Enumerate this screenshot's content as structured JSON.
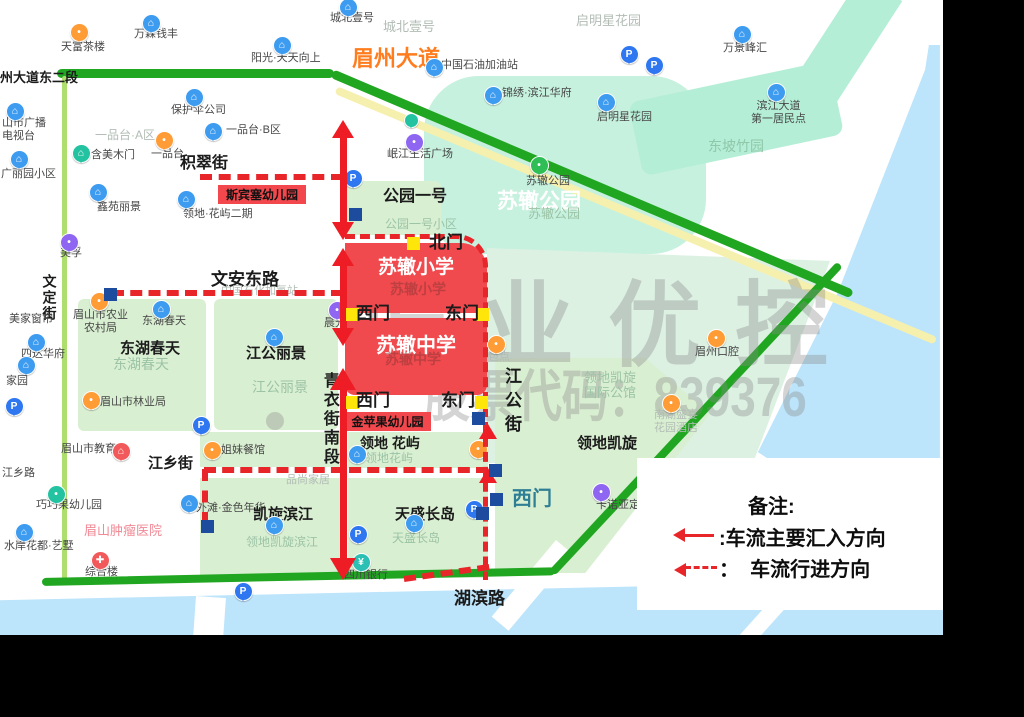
{
  "canvas": {
    "width": 1024,
    "height": 717,
    "map_width": 943,
    "map_height": 635,
    "frame_color": "#000000",
    "map_bg": "#ffffff"
  },
  "palette": {
    "road_green": "#21a621",
    "road_yellow": "#f6f0ae",
    "road_lightgreen": "#aede6e",
    "block_green": "#d9efd2",
    "mint": "#c6f1de",
    "mint2": "#b4eed6",
    "mint3": "#ddf1e3",
    "water": "#bce4fb",
    "white": "#ffffff",
    "red": "#ee1c25",
    "dash_red": "#e8262a",
    "school_red": "#f04a4e",
    "box_red": "#f2484d",
    "yellow_sq": "#ffe60a",
    "blue_sq": "#1d4c9f",
    "pin_blue": "#3d9bf0",
    "pin_orange": "#ff9c35",
    "pin_purple": "#8f66f2",
    "pin_magenta": "#ea5cb5",
    "pin_teal": "#23c2a0",
    "pin_green": "#2ebe55",
    "pin_red": "#f2595b",
    "pin_pblue": "#2e77f0",
    "pin_bank": "#2cc0b4"
  },
  "text_colors": {
    "A": "#474747",
    "B": "#1b1b1b",
    "G": "#9cc3a6",
    "G2": "#8fc7a9",
    "Y": "#b2bcb5",
    "W": "#ffffff",
    "P": "#f08a96",
    "O": "#ff7d1e",
    "R": "rgba(150,55,55,0.55)",
    "T": "#2e7f95"
  },
  "watermark": {
    "line1": "振业优控",
    "line2": "股票代码：839376"
  },
  "legend": {
    "title": "备注:",
    "items": [
      {
        "icon": "solid-left-arrow",
        "label": ":车流主要汇入方向"
      },
      {
        "icon": "dashed-left-arrow",
        "label": "：  车流行进方向"
      }
    ]
  },
  "areas": [
    {
      "name": "suzhe-park",
      "x": 424,
      "y": 76,
      "w": 282,
      "h": 178,
      "color": "mint",
      "radius": "55px"
    },
    {
      "name": "dongpo-bamboo-area",
      "x": 628,
      "y": 103,
      "w": 205,
      "h": 75,
      "color": "mint2",
      "rot": -12,
      "radius": "10px"
    },
    {
      "name": "top-right-band",
      "x": 862,
      "y": -25,
      "w": 48,
      "h": 135,
      "color": "mint2",
      "rot": 33
    },
    {
      "name": "gongyuan-yihao-block",
      "x": 341,
      "y": 181,
      "w": 100,
      "h": 54,
      "color": "block_green",
      "radius": "6px"
    },
    {
      "name": "donghu-block",
      "x": 78,
      "y": 299,
      "w": 128,
      "h": 132,
      "color": "block_green",
      "radius": "6px"
    },
    {
      "name": "jianggong-lijing-block",
      "x": 214,
      "y": 299,
      "w": 124,
      "h": 131,
      "color": "block_green",
      "radius": "6px"
    },
    {
      "name": "jiemei-strip",
      "x": 200,
      "y": 432,
      "w": 141,
      "h": 35,
      "color": "block_green"
    },
    {
      "name": "kaixuan-binjiang-block",
      "x": 200,
      "y": 478,
      "w": 141,
      "h": 100,
      "color": "block_green"
    },
    {
      "name": "lingdi-huayu-block",
      "x": 348,
      "y": 432,
      "w": 140,
      "h": 36,
      "color": "block_green"
    },
    {
      "name": "tiansheng-block",
      "x": 348,
      "y": 478,
      "w": 140,
      "h": 100,
      "color": "block_green"
    },
    {
      "name": "east-mint-region",
      "x": 487,
      "y": 248,
      "w": 350,
      "h": 215,
      "color": "mint3",
      "clip": "polygon(0 0,98% 6%,76% 100%,0 100%)"
    },
    {
      "name": "lingdi-kaixuan-block",
      "x": 495,
      "y": 358,
      "w": 215,
      "h": 215,
      "color": "block_green",
      "clip": "polygon(0 0,70% 0,100% 26%,42% 100%,0 100%)"
    }
  ],
  "water": [
    {
      "name": "river-east",
      "x": 750,
      "y": 40,
      "w": 193,
      "h": 505,
      "color": "water",
      "clip": "polygon(92.7% 1%,98.4% 1%,98.4% 100%,77.7% 100%,4.1% 81.6%,45.6% 49.9%,90.7% 5.9%)"
    },
    {
      "name": "river-south",
      "x": 0,
      "y": 575,
      "w": 943,
      "h": 60,
      "color": "water",
      "clip": "polygon(0 42%,100% 8%,100% 100%,0 100%)"
    },
    {
      "name": "bridge-gap-1",
      "x": 196,
      "y": 596,
      "w": 30,
      "h": 42,
      "color": "white",
      "rot": 4
    },
    {
      "name": "bridge-gap-2",
      "x": 556,
      "y": 540,
      "w": 22,
      "h": 100,
      "color": "white",
      "rot": 40
    },
    {
      "name": "bridge-gap-3",
      "x": 800,
      "y": 568,
      "w": 16,
      "h": 90,
      "color": "white",
      "rot": 42
    }
  ],
  "roads": [
    {
      "name": "riverside-yellow-road",
      "x": 336,
      "y": 86,
      "w": 650,
      "h": 8,
      "color": "road_yellow",
      "rot": 22.7
    },
    {
      "name": "meizhou-dadao-west",
      "x": 57,
      "y": 69,
      "w": 277,
      "h": 9,
      "color": "road_green"
    },
    {
      "name": "meizhou-dadao-east",
      "x": 332,
      "y": 69,
      "w": 565,
      "h": 9,
      "color": "road_green",
      "rot": 23
    },
    {
      "name": "wending-street-road",
      "x": 62,
      "y": 76,
      "w": 5,
      "h": 507,
      "color": "road_lightgreen"
    },
    {
      "name": "hubin-road-west",
      "x": 42,
      "y": 578,
      "w": 513,
      "h": 8,
      "color": "road_green",
      "rot": -1.2
    },
    {
      "name": "hubin-road-east",
      "x": 552,
      "y": 569,
      "w": 422,
      "h": 8,
      "color": "road_green",
      "rot": -47
    }
  ],
  "labels": [
    {
      "t": "州大道东二段",
      "x": 0,
      "y": 70,
      "s": 13,
      "c": "B",
      "b": 1
    },
    {
      "t": "眉州大道",
      "x": 352,
      "y": 46,
      "s": 22,
      "c": "O",
      "b": 1
    },
    {
      "t": "天富茶楼",
      "x": 61,
      "y": 41,
      "s": 11,
      "c": "A"
    },
    {
      "t": "万霖钱丰",
      "x": 134,
      "y": 28,
      "s": 11,
      "c": "A"
    },
    {
      "t": "阳光·天天向上",
      "x": 251,
      "y": 52,
      "s": 11,
      "c": "A"
    },
    {
      "t": "城北壹号",
      "x": 330,
      "y": 12,
      "s": 11,
      "c": "A"
    },
    {
      "t": "城北壹号",
      "x": 383,
      "y": 19,
      "s": 13,
      "c": "Y"
    },
    {
      "t": "启明星花园",
      "x": 576,
      "y": 13,
      "s": 13,
      "c": "Y"
    },
    {
      "t": "万景峰汇",
      "x": 723,
      "y": 42,
      "s": 11,
      "c": "A"
    },
    {
      "t": "中国石油加油站",
      "x": 441,
      "y": 59,
      "s": 11,
      "c": "A"
    },
    {
      "t": "锦绣·滨江华府",
      "x": 502,
      "y": 87,
      "s": 11,
      "c": "A"
    },
    {
      "t": "启明星花园",
      "x": 597,
      "y": 111,
      "s": 11,
      "c": "A"
    },
    {
      "t": "滨江大道\n第一居民点",
      "x": 751,
      "y": 100,
      "s": 11,
      "c": "A",
      "ctr": 1
    },
    {
      "t": "东坡竹园",
      "x": 708,
      "y": 138,
      "s": 14,
      "c": "G2"
    },
    {
      "t": "保护伞公司",
      "x": 171,
      "y": 104,
      "s": 11,
      "c": "A"
    },
    {
      "t": "一品台·A区",
      "x": 95,
      "y": 128,
      "s": 12,
      "c": "Y"
    },
    {
      "t": "一品台·B区",
      "x": 226,
      "y": 124,
      "s": 11,
      "c": "A"
    },
    {
      "t": "一品台",
      "x": 151,
      "y": 148,
      "s": 11,
      "c": "A"
    },
    {
      "t": "含美木门",
      "x": 91,
      "y": 149,
      "s": 11,
      "c": "A"
    },
    {
      "t": "山市广播\n电视台",
      "x": 2,
      "y": 117,
      "s": 11,
      "c": "A"
    },
    {
      "t": "广丽园小区",
      "x": 1,
      "y": 168,
      "s": 11,
      "c": "A"
    },
    {
      "t": "鑫苑丽景",
      "x": 97,
      "y": 201,
      "s": 11,
      "c": "A"
    },
    {
      "t": "领地·花屿二期",
      "x": 183,
      "y": 208,
      "s": 11,
      "c": "A"
    },
    {
      "t": "积翠街",
      "x": 180,
      "y": 155,
      "s": 16,
      "c": "B",
      "b": 1
    },
    {
      "t": "公园一号",
      "x": 383,
      "y": 188,
      "s": 16,
      "c": "B",
      "b": 1
    },
    {
      "t": "公园一号小区",
      "x": 385,
      "y": 217,
      "s": 12,
      "c": "G"
    },
    {
      "t": "苏辙公园",
      "x": 497,
      "y": 190,
      "s": 21,
      "c": "W",
      "b": 1
    },
    {
      "t": "苏辙公园",
      "x": 526,
      "y": 175,
      "s": 11,
      "c": "A"
    },
    {
      "t": "苏辙公园",
      "x": 528,
      "y": 206,
      "s": 13,
      "c": "G"
    },
    {
      "t": "岷江生活广场",
      "x": 387,
      "y": 148,
      "s": 11,
      "c": "A"
    },
    {
      "t": "美孚",
      "x": 60,
      "y": 247,
      "s": 11,
      "c": "A"
    },
    {
      "t": "文安东路",
      "x": 211,
      "y": 270,
      "s": 17,
      "c": "B",
      "b": 1
    },
    {
      "t": "中国石化加氢站",
      "x": 221,
      "y": 285,
      "s": 11,
      "c": "Y"
    },
    {
      "t": "晨光文具",
      "x": 324,
      "y": 317,
      "s": 11,
      "c": "A"
    },
    {
      "t": "文定街",
      "x": 41,
      "y": 274,
      "s": 14,
      "c": "B",
      "b": 1,
      "v": 1,
      "ls": 2
    },
    {
      "t": "美家窗帘",
      "x": 9,
      "y": 313,
      "s": 11,
      "c": "A"
    },
    {
      "t": "四达华府",
      "x": 21,
      "y": 348,
      "s": 11,
      "c": "A"
    },
    {
      "t": "家园",
      "x": 6,
      "y": 375,
      "s": 11,
      "c": "A"
    },
    {
      "t": "眉山市农业\n农村局",
      "x": 73,
      "y": 309,
      "s": 11,
      "c": "A",
      "ctr": 1
    },
    {
      "t": "东湖春天",
      "x": 142,
      "y": 315,
      "s": 11,
      "c": "A"
    },
    {
      "t": "东湖春天",
      "x": 120,
      "y": 340,
      "s": 15,
      "c": "B",
      "b": 1
    },
    {
      "t": "东湖春天",
      "x": 113,
      "y": 356,
      "s": 14,
      "c": "G"
    },
    {
      "t": "江公丽景",
      "x": 246,
      "y": 345,
      "s": 15,
      "c": "B",
      "b": 1
    },
    {
      "t": "江公丽景",
      "x": 252,
      "y": 379,
      "s": 14,
      "c": "G"
    },
    {
      "t": "眉山市林业局",
      "x": 100,
      "y": 396,
      "s": 11,
      "c": "A"
    },
    {
      "t": "青衣街南段",
      "x": 319,
      "y": 372,
      "s": 16,
      "c": "B",
      "b": 1,
      "v": 1,
      "ls": 3
    },
    {
      "t": "江公街",
      "x": 501,
      "y": 367,
      "s": 17,
      "c": "B",
      "b": 1,
      "v": 1,
      "ls": 7
    },
    {
      "t": "香兰麻辣烫",
      "x": 348,
      "y": 380,
      "s": 11,
      "c": "Y"
    },
    {
      "t": "紫燕包点",
      "x": 466,
      "y": 351,
      "s": 11,
      "c": "Y"
    },
    {
      "t": "领地凯旋\n国际公馆",
      "x": 584,
      "y": 370,
      "s": 13,
      "c": "G"
    },
    {
      "t": "眉州口腔",
      "x": 695,
      "y": 346,
      "s": 11,
      "c": "A"
    },
    {
      "t": "南湖盛宴\n花园酒店",
      "x": 654,
      "y": 409,
      "s": 11,
      "c": "Y",
      "ctr": 1
    },
    {
      "t": "领地凯旋",
      "x": 577,
      "y": 435,
      "s": 15,
      "c": "B",
      "b": 1
    },
    {
      "t": "江乡路",
      "x": 2,
      "y": 467,
      "s": 11,
      "c": "A"
    },
    {
      "t": "眉山市教育局",
      "x": 61,
      "y": 443,
      "s": 11,
      "c": "A"
    },
    {
      "t": "江乡街",
      "x": 148,
      "y": 455,
      "s": 15,
      "c": "B",
      "b": 1
    },
    {
      "t": "姐妹餐馆",
      "x": 221,
      "y": 444,
      "s": 11,
      "c": "A"
    },
    {
      "t": "领地 花屿",
      "x": 360,
      "y": 435,
      "s": 14,
      "c": "B",
      "b": 1
    },
    {
      "t": "领地花屿",
      "x": 365,
      "y": 451,
      "s": 12,
      "c": "G"
    },
    {
      "t": "品尚家居",
      "x": 286,
      "y": 474,
      "s": 11,
      "c": "Y"
    },
    {
      "t": "巧巧果幼儿园",
      "x": 36,
      "y": 499,
      "s": 11,
      "c": "A"
    },
    {
      "t": "外滩·金色年华",
      "x": 196,
      "y": 502,
      "s": 11,
      "c": "A"
    },
    {
      "t": "凯旋滨江",
      "x": 253,
      "y": 506,
      "s": 15,
      "c": "B",
      "b": 1
    },
    {
      "t": "领地凯旋滨江",
      "x": 246,
      "y": 535,
      "s": 12,
      "c": "G"
    },
    {
      "t": "天盛长岛",
      "x": 395,
      "y": 506,
      "s": 15,
      "c": "B",
      "b": 1
    },
    {
      "t": "天盛长岛",
      "x": 392,
      "y": 531,
      "s": 12,
      "c": "G"
    },
    {
      "t": "卡诺亚定制",
      "x": 596,
      "y": 499,
      "s": 11,
      "c": "A"
    },
    {
      "t": "眉山肿瘤医院",
      "x": 84,
      "y": 523,
      "s": 13,
      "c": "P"
    },
    {
      "t": "水岸花都·艺墅",
      "x": 4,
      "y": 540,
      "s": 11,
      "c": "A"
    },
    {
      "t": "综合楼",
      "x": 85,
      "y": 566,
      "s": 11,
      "c": "A"
    },
    {
      "t": "四川银行",
      "x": 344,
      "y": 569,
      "s": 11,
      "c": "A"
    },
    {
      "t": "湖滨路",
      "x": 454,
      "y": 589,
      "s": 17,
      "c": "B",
      "b": 1
    }
  ],
  "pins": [
    {
      "x": 150,
      "y": 22,
      "c": "pin_blue",
      "g": "⌂"
    },
    {
      "x": 281,
      "y": 44,
      "c": "pin_blue",
      "g": "⌂"
    },
    {
      "x": 347,
      "y": 6,
      "c": "pin_blue",
      "g": "⌂"
    },
    {
      "x": 193,
      "y": 96,
      "c": "pin_blue",
      "g": "⌂"
    },
    {
      "x": 212,
      "y": 130,
      "c": "pin_blue",
      "g": "⌂"
    },
    {
      "x": 14,
      "y": 110,
      "c": "pin_blue",
      "g": "⌂"
    },
    {
      "x": 18,
      "y": 158,
      "c": "pin_blue",
      "g": "⌂"
    },
    {
      "x": 97,
      "y": 191,
      "c": "pin_blue",
      "g": "⌂"
    },
    {
      "x": 185,
      "y": 198,
      "c": "pin_blue",
      "g": "⌂"
    },
    {
      "x": 160,
      "y": 308,
      "c": "pin_blue",
      "g": "⌂"
    },
    {
      "x": 273,
      "y": 336,
      "c": "pin_blue",
      "g": "⌂"
    },
    {
      "x": 35,
      "y": 341,
      "c": "pin_blue",
      "g": "⌂"
    },
    {
      "x": 25,
      "y": 364,
      "c": "pin_blue",
      "g": "⌂"
    },
    {
      "x": 188,
      "y": 502,
      "c": "pin_blue",
      "g": "⌂"
    },
    {
      "x": 273,
      "y": 524,
      "c": "pin_blue",
      "g": "⌂"
    },
    {
      "x": 413,
      "y": 522,
      "c": "pin_blue",
      "g": "⌂"
    },
    {
      "x": 605,
      "y": 101,
      "c": "pin_blue",
      "g": "⌂"
    },
    {
      "x": 492,
      "y": 94,
      "c": "pin_blue",
      "g": "⌂"
    },
    {
      "x": 775,
      "y": 91,
      "c": "pin_blue",
      "g": "⌂"
    },
    {
      "x": 741,
      "y": 33,
      "c": "pin_blue",
      "g": "⌂"
    },
    {
      "x": 433,
      "y": 66,
      "c": "pin_blue",
      "g": "⌂"
    },
    {
      "x": 356,
      "y": 453,
      "c": "pin_blue",
      "g": "⌂"
    },
    {
      "x": 23,
      "y": 531,
      "c": "pin_blue",
      "g": "⌂"
    },
    {
      "x": 78,
      "y": 31,
      "c": "pin_orange",
      "g": "•"
    },
    {
      "x": 163,
      "y": 139,
      "c": "pin_orange",
      "g": "•"
    },
    {
      "x": 98,
      "y": 300,
      "c": "pin_orange",
      "g": "•"
    },
    {
      "x": 90,
      "y": 399,
      "c": "pin_orange",
      "g": "•"
    },
    {
      "x": 211,
      "y": 449,
      "c": "pin_orange",
      "g": "•"
    },
    {
      "x": 495,
      "y": 343,
      "c": "pin_orange",
      "g": "•"
    },
    {
      "x": 477,
      "y": 448,
      "c": "pin_orange",
      "g": "•"
    },
    {
      "x": 670,
      "y": 402,
      "c": "pin_orange",
      "g": "•"
    },
    {
      "x": 715,
      "y": 337,
      "c": "pin_orange",
      "g": "•"
    },
    {
      "x": 68,
      "y": 241,
      "c": "pin_purple",
      "g": "•"
    },
    {
      "x": 336,
      "y": 309,
      "c": "pin_purple",
      "g": "•"
    },
    {
      "x": 413,
      "y": 141,
      "c": "pin_purple",
      "g": "•"
    },
    {
      "x": 600,
      "y": 491,
      "c": "pin_purple",
      "g": "•"
    },
    {
      "x": 370,
      "y": 256,
      "c": "pin_magenta",
      "g": "P",
      "top": 1
    },
    {
      "x": 80,
      "y": 152,
      "c": "pin_teal",
      "g": "⌂"
    },
    {
      "x": 55,
      "y": 493,
      "c": "pin_teal",
      "g": "•"
    },
    {
      "x": 410,
      "y": 119,
      "c": "pin_teal",
      "g": "",
      "sz": 13
    },
    {
      "x": 360,
      "y": 561,
      "c": "pin_bank",
      "g": "¥"
    },
    {
      "x": 538,
      "y": 164,
      "c": "pin_green",
      "g": "•"
    },
    {
      "x": 120,
      "y": 450,
      "c": "pin_red",
      "g": "⌂"
    },
    {
      "x": 99,
      "y": 559,
      "c": "pin_red",
      "g": "✚"
    },
    {
      "x": 352,
      "y": 177,
      "c": "pin_pblue",
      "g": "P"
    },
    {
      "x": 628,
      "y": 53,
      "c": "pin_pblue",
      "g": "P"
    },
    {
      "x": 653,
      "y": 64,
      "c": "pin_pblue",
      "g": "P"
    },
    {
      "x": 13,
      "y": 405,
      "c": "pin_pblue",
      "g": "P"
    },
    {
      "x": 200,
      "y": 424,
      "c": "pin_pblue",
      "g": "P"
    },
    {
      "x": 242,
      "y": 590,
      "c": "pin_pblue",
      "g": "P"
    },
    {
      "x": 357,
      "y": 533,
      "c": "pin_pblue",
      "g": "P"
    },
    {
      "x": 473,
      "y": 508,
      "c": "pin_pblue",
      "g": "P"
    }
  ],
  "gates": {
    "yellow_squares": [
      [
        407,
        237
      ],
      [
        346,
        308
      ],
      [
        476,
        308
      ],
      [
        346,
        396
      ],
      [
        475,
        396
      ]
    ],
    "blue_squares": [
      [
        104,
        288
      ],
      [
        349,
        208
      ],
      [
        201,
        520
      ],
      [
        472,
        412
      ],
      [
        489,
        464
      ],
      [
        490,
        493
      ],
      [
        476,
        507
      ]
    ],
    "labels": [
      {
        "t": "北门",
        "x": 429,
        "y": 233,
        "s": 17,
        "c": "B"
      },
      {
        "t": "西门",
        "x": 356,
        "y": 304,
        "s": 17,
        "c": "B"
      },
      {
        "t": "东门",
        "x": 445,
        "y": 304,
        "s": 17,
        "c": "B"
      },
      {
        "t": "西门",
        "x": 356,
        "y": 391,
        "s": 17,
        "c": "B"
      },
      {
        "t": "东门",
        "x": 441,
        "y": 391,
        "s": 17,
        "c": "B"
      },
      {
        "t": "西门",
        "x": 512,
        "y": 488,
        "s": 20,
        "c": "T"
      }
    ]
  },
  "red_overlay": {
    "school_blocks": [
      {
        "label": "苏辙小学",
        "x": 345,
        "y": 243,
        "w": 142,
        "h": 70,
        "radius": "0 26px 0 0",
        "pad": 9,
        "fs": 19
      },
      {
        "label": "苏辙中学",
        "x": 345,
        "y": 318,
        "w": 142,
        "h": 77,
        "radius": "0 0 10px 10px",
        "pad": 11,
        "fs": 20
      }
    ],
    "ghost_labels": [
      {
        "t": "苏辙小学",
        "x": 390,
        "y": 281,
        "s": 14
      },
      {
        "t": "苏辙中学",
        "x": 385,
        "y": 351,
        "s": 14
      }
    ],
    "label_boxes": [
      {
        "t": "斯宾塞幼儿园",
        "x": 218,
        "y": 185,
        "w": 88,
        "h": 19,
        "fs": 12
      },
      {
        "t": "金苹果幼儿园",
        "x": 344,
        "y": 412,
        "w": 87,
        "h": 19,
        "fs": 12
      }
    ],
    "dashed": [
      {
        "d": "h",
        "x": 200,
        "y": 174,
        "len": 143
      },
      {
        "d": "h",
        "x": 112,
        "y": 290,
        "len": 231
      },
      {
        "d": "corner",
        "x": 345,
        "y": 234,
        "w": 138,
        "h": 341
      },
      {
        "d": "h",
        "x": 204,
        "y": 467,
        "len": 284
      },
      {
        "d": "v",
        "x": 202,
        "y": 469,
        "len": 55
      },
      {
        "d": "h",
        "x": 404,
        "y": 576,
        "len": 86,
        "rot": -8
      }
    ],
    "double_arrows": [
      {
        "x": 343,
        "y1": 120,
        "y2": 240
      },
      {
        "x": 343,
        "y1": 248,
        "y2": 346
      },
      {
        "x": 343,
        "y1": 368,
        "y2": 580,
        "big": 1
      }
    ],
    "flow_arrowheads": [
      {
        "x": 488,
        "y": 424
      },
      {
        "x": 488,
        "y": 468
      }
    ]
  }
}
